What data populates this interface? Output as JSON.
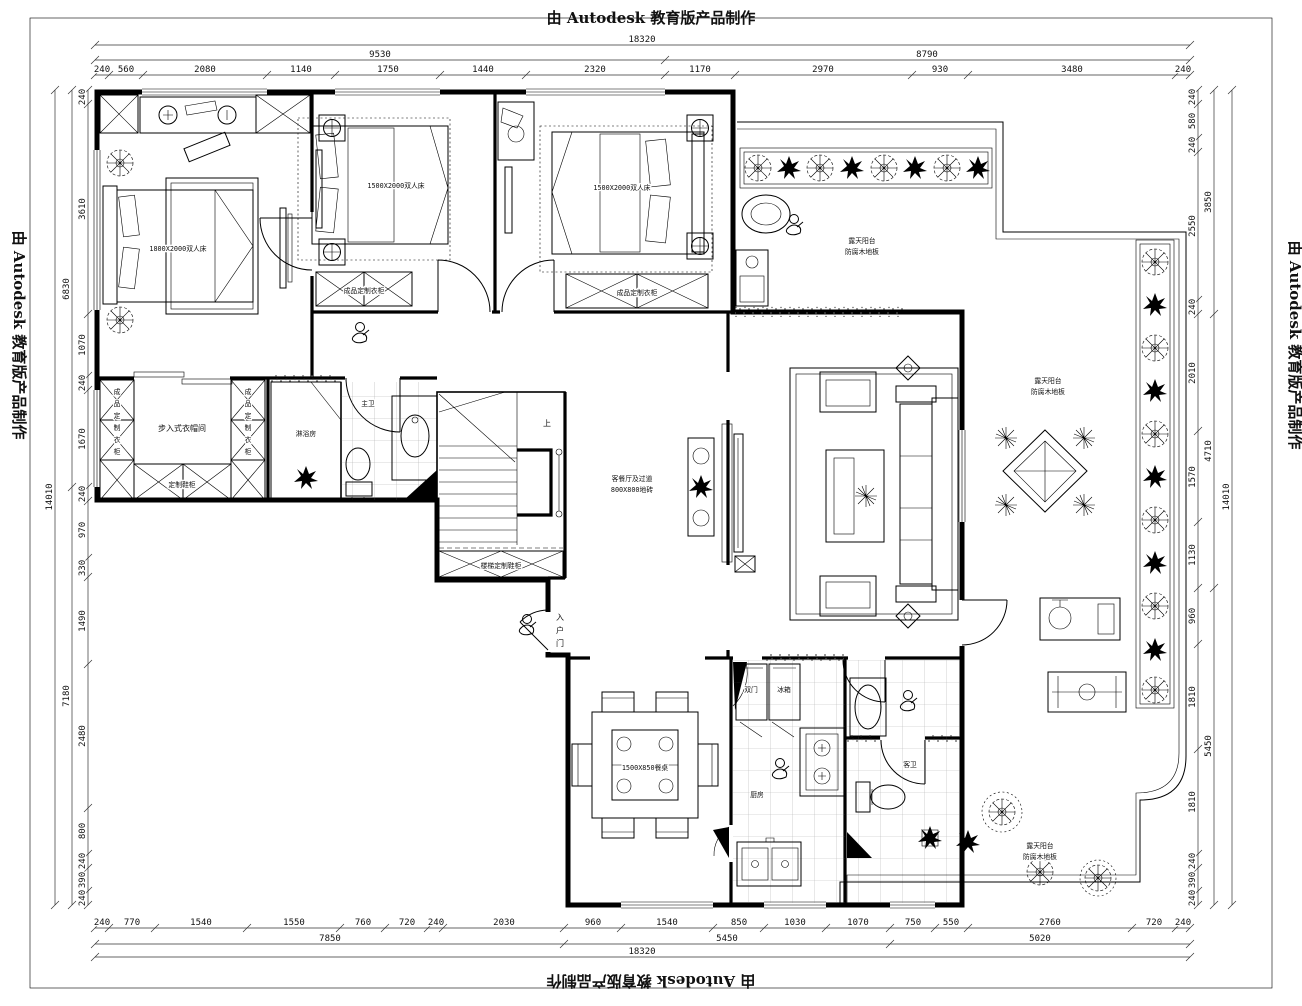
{
  "watermark": "由 Autodesk 教育版产品制作",
  "labels": {
    "master_bed": "1800X2000双人床",
    "bed2": "1500X2000双人床",
    "bed3": "1500X2000双人床",
    "wardrobe": "成品定制衣柜",
    "closet": "步入式衣帽间",
    "shoe_cabinet": "定制鞋柜",
    "stair_cabinet": "楼梯定制鞋柜",
    "stair_up": "上",
    "entry_door": "入户门",
    "master_bath": "主卫",
    "shower": "淋浴房",
    "guest_bath": "客卫",
    "kitchen": "厨房",
    "fridge_left": "双门",
    "fridge_right": "冰箱",
    "dining_table": "1500X850餐桌",
    "corridor_1": "客餐厅及过道",
    "corridor_2": "800X800地砖",
    "terrace": "露天阳台",
    "terrace_sub": "防腐木地板"
  },
  "dimensions": {
    "top": {
      "total": "18320",
      "row2": [
        "9530",
        "8790"
      ],
      "row3": [
        "240",
        "560",
        "2080",
        "1140",
        "1750",
        "1440",
        "2320",
        "1170",
        "2970",
        "930",
        "3480",
        "240"
      ]
    },
    "bottom": {
      "total": "18320",
      "row2": [
        "7850",
        "5450",
        "5020"
      ],
      "row1": [
        "240",
        "770",
        "1540",
        "1550",
        "760",
        "720",
        "240",
        "2030",
        "960",
        "1540",
        "850",
        "1030",
        "1070",
        "750",
        "550",
        "2760",
        "720",
        "240"
      ]
    },
    "left": {
      "total": "14010",
      "col2": [
        "6830",
        "7180"
      ],
      "col1": [
        "240",
        "3610",
        "1070",
        "240",
        "1670",
        "240",
        "970",
        "330",
        "1490",
        "2480",
        "800",
        "240",
        "390",
        "240"
      ]
    },
    "right": {
      "total": "14010",
      "col2": [
        "3850",
        "4710",
        "5450"
      ],
      "col1": [
        "240",
        "580",
        "240",
        "2550",
        "240",
        "2010",
        "1570",
        "1130",
        "960",
        "1810",
        "1810",
        "240",
        "390",
        "240"
      ]
    }
  }
}
